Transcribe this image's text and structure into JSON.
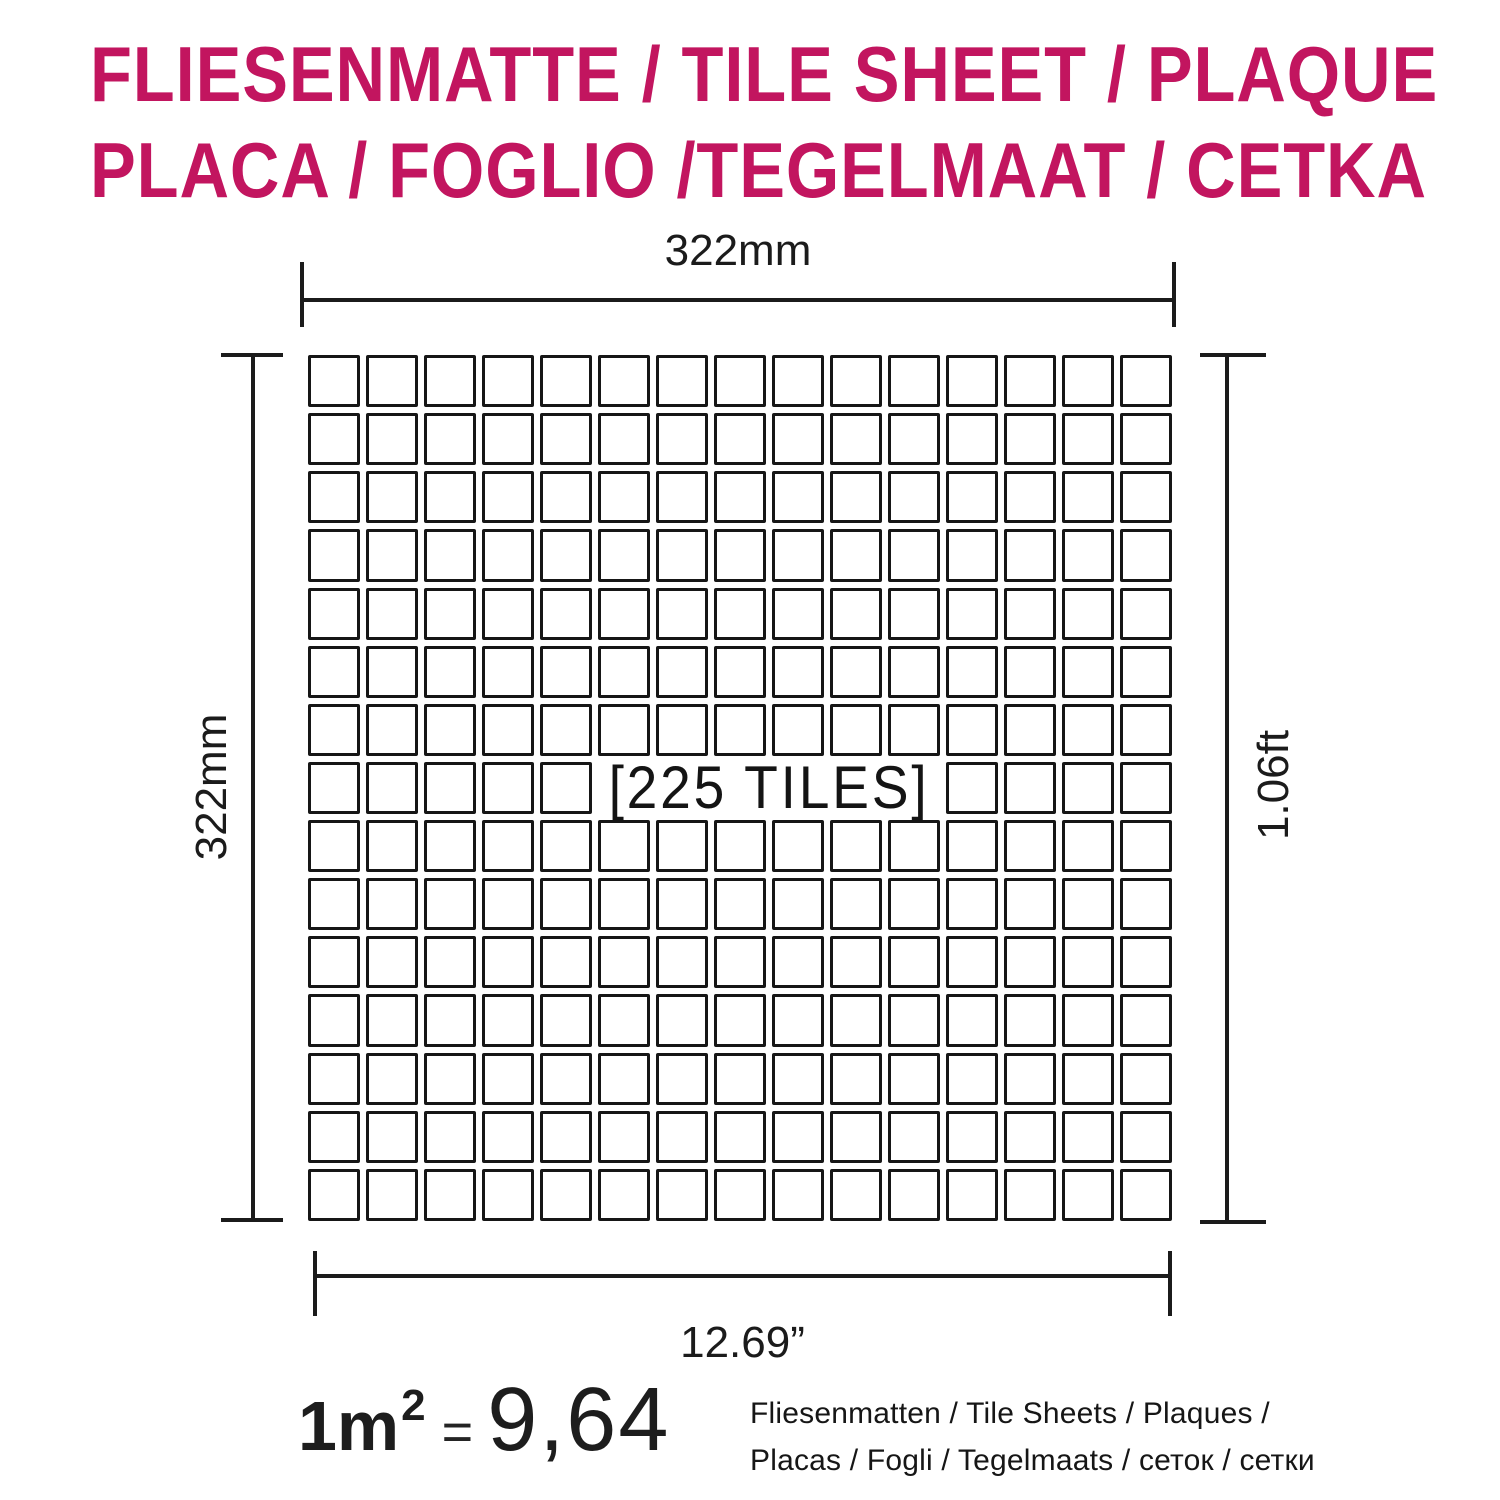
{
  "colors": {
    "accent": "#c2155f",
    "line": "#1b1b1b",
    "background": "#ffffff"
  },
  "title": {
    "line1": "FLIESENMATTE / TILE SHEET / PLAQUE",
    "line2": "PLACA / FOGLIO /TEGELMAAT / CETKA"
  },
  "sheet": {
    "width_label_top": "322mm",
    "height_label_left": "322mm",
    "height_label_right": "1.06ft",
    "width_label_bottom": "12.69”",
    "tiles_label": "[225 TILES]",
    "grid": {
      "rows": 15,
      "cols": 15,
      "total_tiles": 225,
      "label_row": 7,
      "label_col_start": 5,
      "label_col_end": 10
    }
  },
  "footer": {
    "coverage": {
      "base": "1m",
      "superscript": "2",
      "equals": "=",
      "value": "9,64"
    },
    "caption_line1": "Fliesenmatten / Tile Sheets /  Plaques /",
    "caption_line2": "Placas / Fogli / Tegelmaats / сеток / сетки"
  }
}
